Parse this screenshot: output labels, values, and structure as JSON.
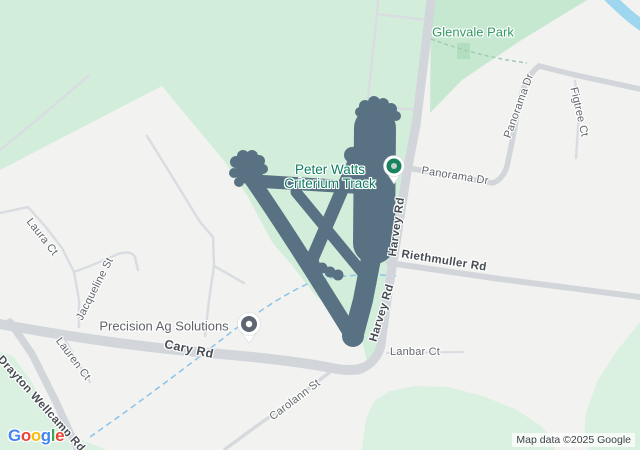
{
  "map": {
    "attribution": "Map data ©2025 Google",
    "logo_letters": [
      [
        "G",
        "#4285F4"
      ],
      [
        "o",
        "#EA4335"
      ],
      [
        "o",
        "#FBBC05"
      ],
      [
        "g",
        "#4285F4"
      ],
      [
        "l",
        "#34A853"
      ],
      [
        "e",
        "#EA4335"
      ]
    ],
    "labels": {
      "glenvale_park": "Glenvale Park",
      "panorama_dr": "Panorama Dr",
      "panorama_dr_vertical": "Panorama Dr",
      "figtree_ct": "Figtree Ct",
      "harvey_rd_upper": "Harvey Rd",
      "harvey_rd_lower": "Harvey Rd",
      "riethmuller_rd": "Riethmuller Rd",
      "lanbar_ct": "Lanbar Ct",
      "carolann_st": "Carolann St",
      "cary_rd": "Cary Rd",
      "jacqueline_st": "Jacqueline St",
      "laura_ct": "Laura Ct",
      "lauren_ct": "Lauren Ct",
      "drayton_wellcamp_rd": "Drayton Wellcamp Rd",
      "peter_watts_line1": "Peter Watts",
      "peter_watts_line2": "Criterium Track",
      "precision_ag": "Precision Ag Solutions"
    },
    "colors": {
      "background": "#f2f3f1",
      "park_green_west": "#d2eedb",
      "glenvale_green": "#c6e8d0",
      "sports_field_green": "#b3ddbf",
      "bottom_green": "#daf0e1",
      "road_gray": "#d2d6db",
      "minor_road_gray": "#d9dde1",
      "track_overlay_slate": "#597283",
      "water_blue": "#9ed6f0",
      "stream_dashed_blue": "#8fc5e9",
      "poi_text_green": "#0d7c5f",
      "park_label_green": "#319a62",
      "pin_green": "#17835f",
      "pin_gray": "#5e6771"
    }
  }
}
